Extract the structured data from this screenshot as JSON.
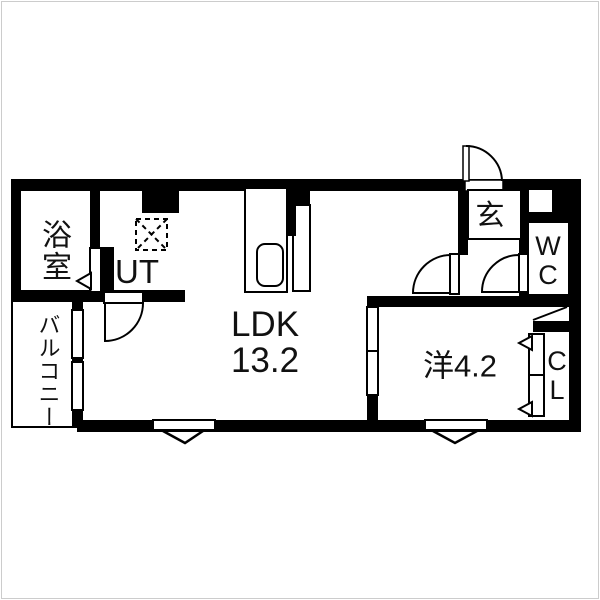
{
  "colors": {
    "wall": "#000000",
    "background": "#ffffff",
    "frame_border": "#cccccc",
    "text": "#111111"
  },
  "rooms": {
    "bathroom": {
      "label": "浴室"
    },
    "utility": {
      "label": "UT"
    },
    "ldk": {
      "label": "LDK",
      "area": "13.2"
    },
    "entrance": {
      "label": "玄"
    },
    "toilet": {
      "line1": "W",
      "line2": "C"
    },
    "western_room": {
      "label": "洋4.2"
    },
    "closet": {
      "line1": "C",
      "line2": "L"
    },
    "balcony": {
      "label": "バルコニー"
    }
  }
}
